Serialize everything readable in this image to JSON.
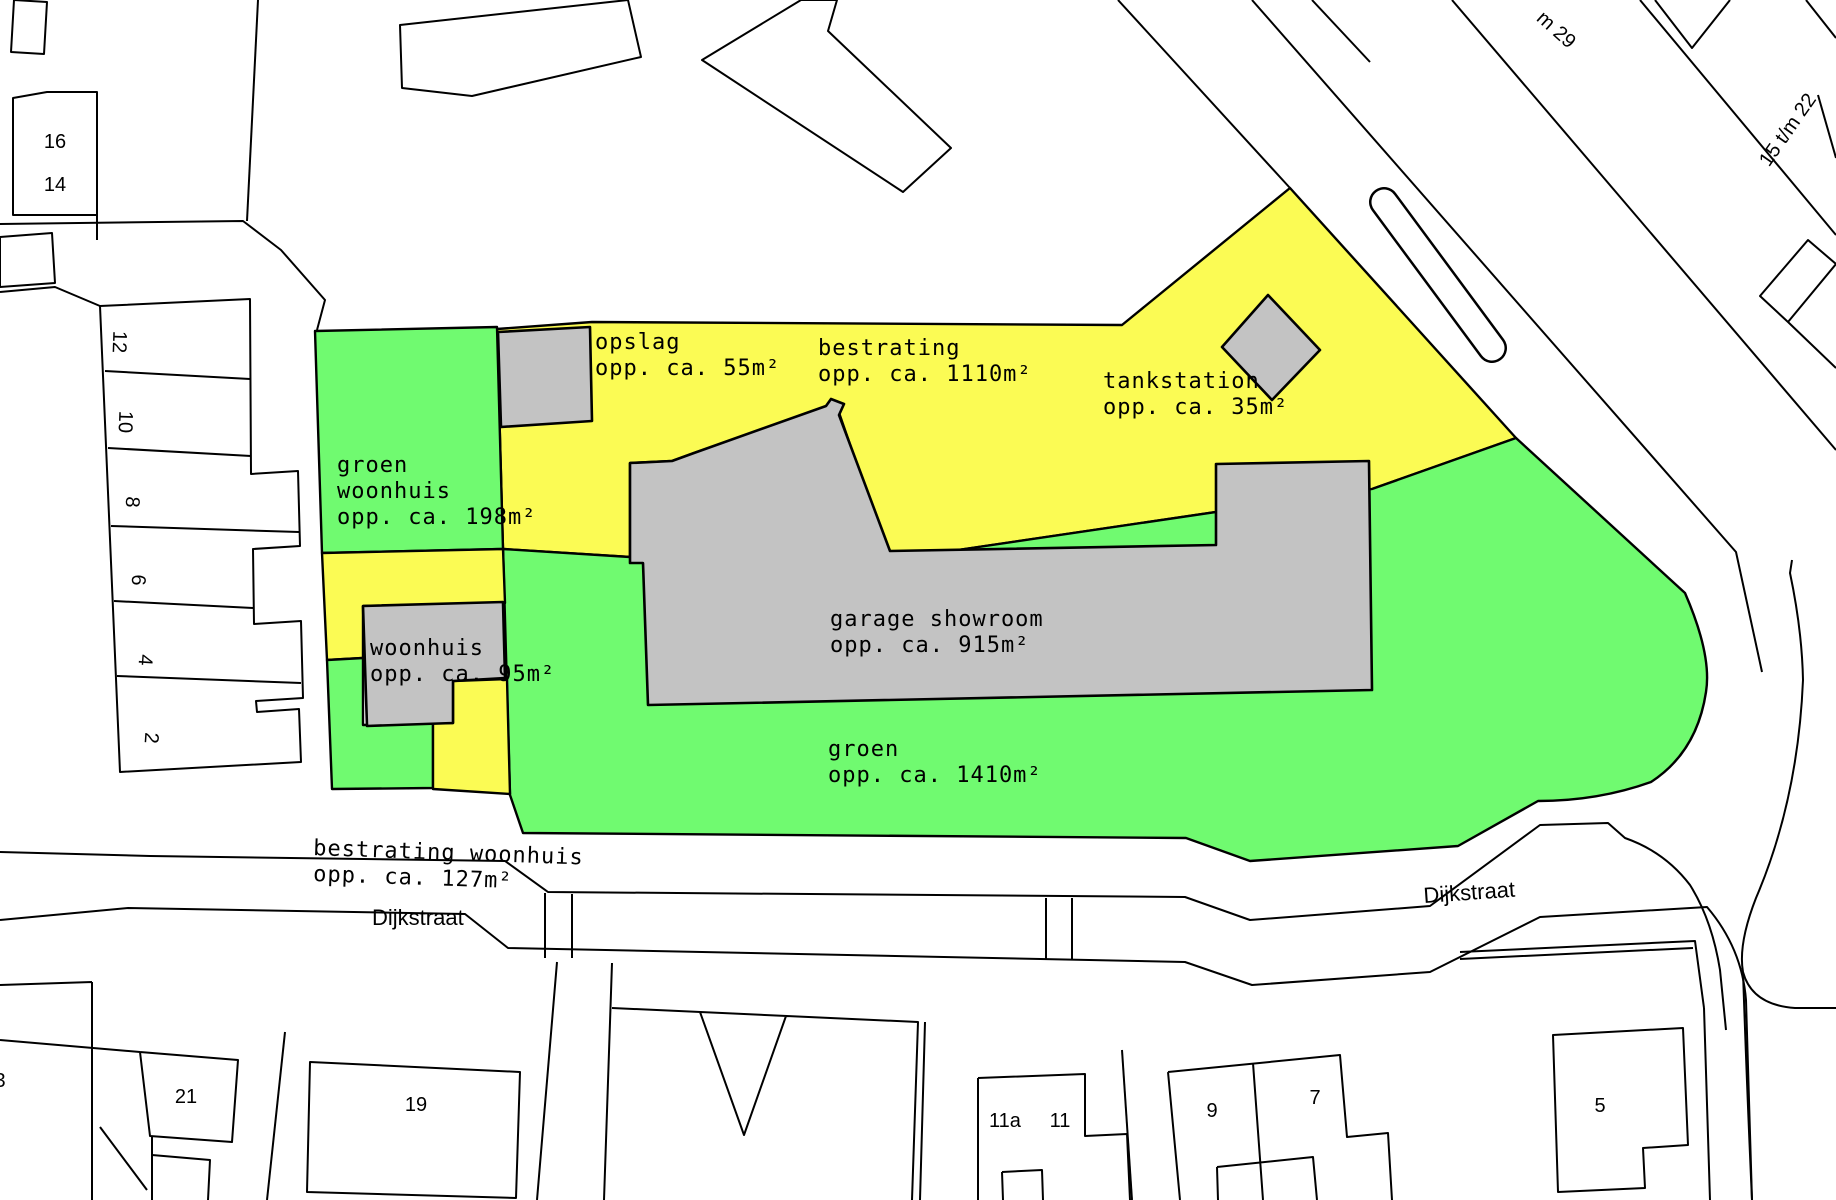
{
  "colors": {
    "yellow": "#FBFB54",
    "green": "#70FA70",
    "building_gray": "#C3C3C3",
    "outline": "#000000",
    "background": "#FFFFFF"
  },
  "areas": {
    "opslag": {
      "name": "opslag",
      "area": "opp. ca. 55m²"
    },
    "bestrating": {
      "name": "bestrating",
      "area": "opp. ca. 1110m²"
    },
    "tankstation": {
      "name": "tankstation",
      "area": "opp. ca. 35m²"
    },
    "groen_woonhuis": {
      "name": "groen",
      "name2": "woonhuis",
      "area": "opp. ca. 198m²"
    },
    "woonhuis": {
      "name": "woonhuis",
      "area": "opp. ca. 95m²"
    },
    "garage": {
      "name": "garage showroom",
      "area": "opp. ca. 915m²"
    },
    "groen": {
      "name": "groen",
      "area": "opp. ca. 1410m²"
    },
    "bestrating_woonhuis": {
      "name": "bestrating woonhuis",
      "area": "opp. ca. 127m²"
    }
  },
  "streets": {
    "dijkstraat_left": "Dijkstraat",
    "dijkstraat_right": "Dijkstraat"
  },
  "house_numbers": {
    "h16": "16",
    "h14": "14",
    "h12": "12",
    "h10": "10",
    "h8": "8",
    "h6": "6",
    "h4": "4",
    "h2": "2",
    "h21": "21",
    "h19": "19",
    "h11a": "11a",
    "h11": "11",
    "h9": "9",
    "h7": "7",
    "h5": "5",
    "h3": "3",
    "range_right": "15 t/m 22",
    "range_top": "m 29"
  }
}
